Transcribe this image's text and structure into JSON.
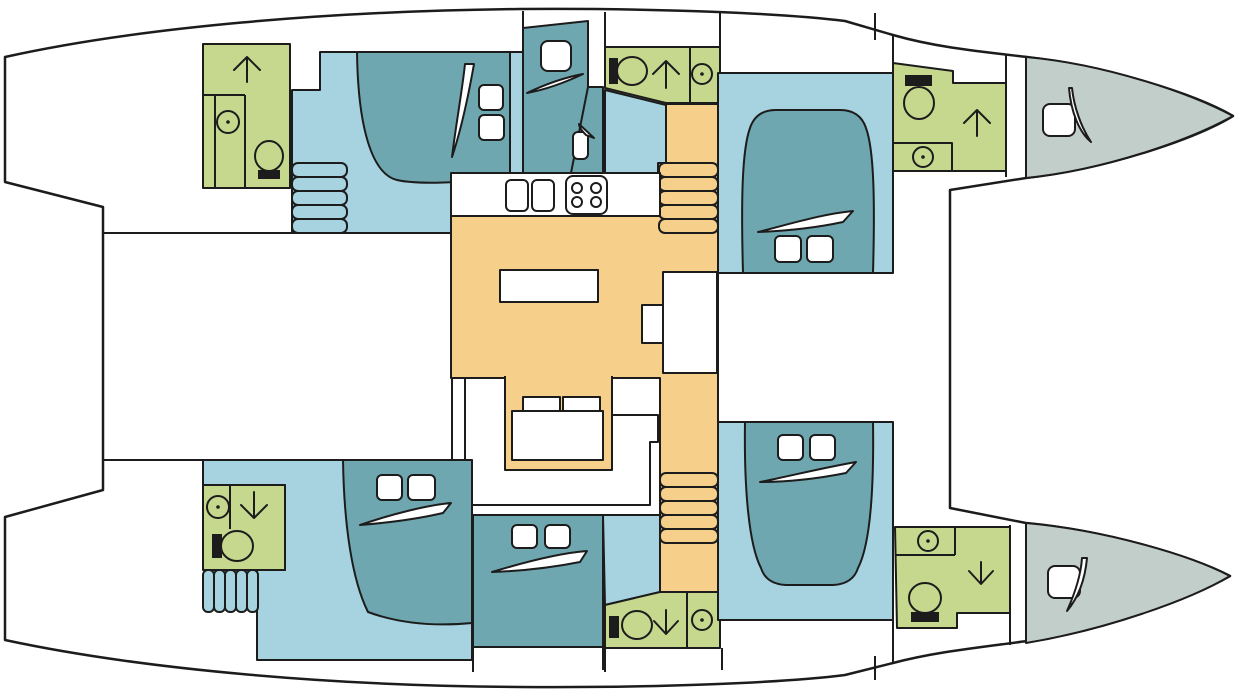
{
  "meta": {
    "diagram_type": "catamaran-interior-deck-plan",
    "orientation": {
      "bow": "right",
      "stern": "left"
    },
    "counts": {
      "sleeping_areas": 6,
      "bathrooms": 6,
      "bow_lockers": 2,
      "stairways": 2
    }
  },
  "colors": {
    "line": "#1c1c1c",
    "white": "#ffffff",
    "floor": "#a6d3df",
    "bed": "#6fa7b0",
    "wet": "#c6d78e",
    "salon": "#f6cf8b",
    "bow": "#c2cec9"
  },
  "rooms": {
    "salon": {
      "fixtures": [
        "galley-counter",
        "double-sink",
        "stove-4-burner",
        "island-counter",
        "chart-table",
        "u-settee",
        "dining-table"
      ]
    },
    "port_hull": [
      "aft-bathroom",
      "aft-cabin",
      "single-berth",
      "entry-bathroom",
      "stairway",
      "forward-cabin",
      "forward-bathroom",
      "bow-locker"
    ],
    "starboard_hull": [
      "aft-bathroom",
      "aft-cabin",
      "mid-cabin",
      "entry-bathroom",
      "stairway",
      "forward-cabin",
      "forward-bathroom",
      "bow-locker"
    ],
    "bathroom_fixtures": [
      "toilet",
      "washbasin",
      "shower-arrow"
    ]
  }
}
